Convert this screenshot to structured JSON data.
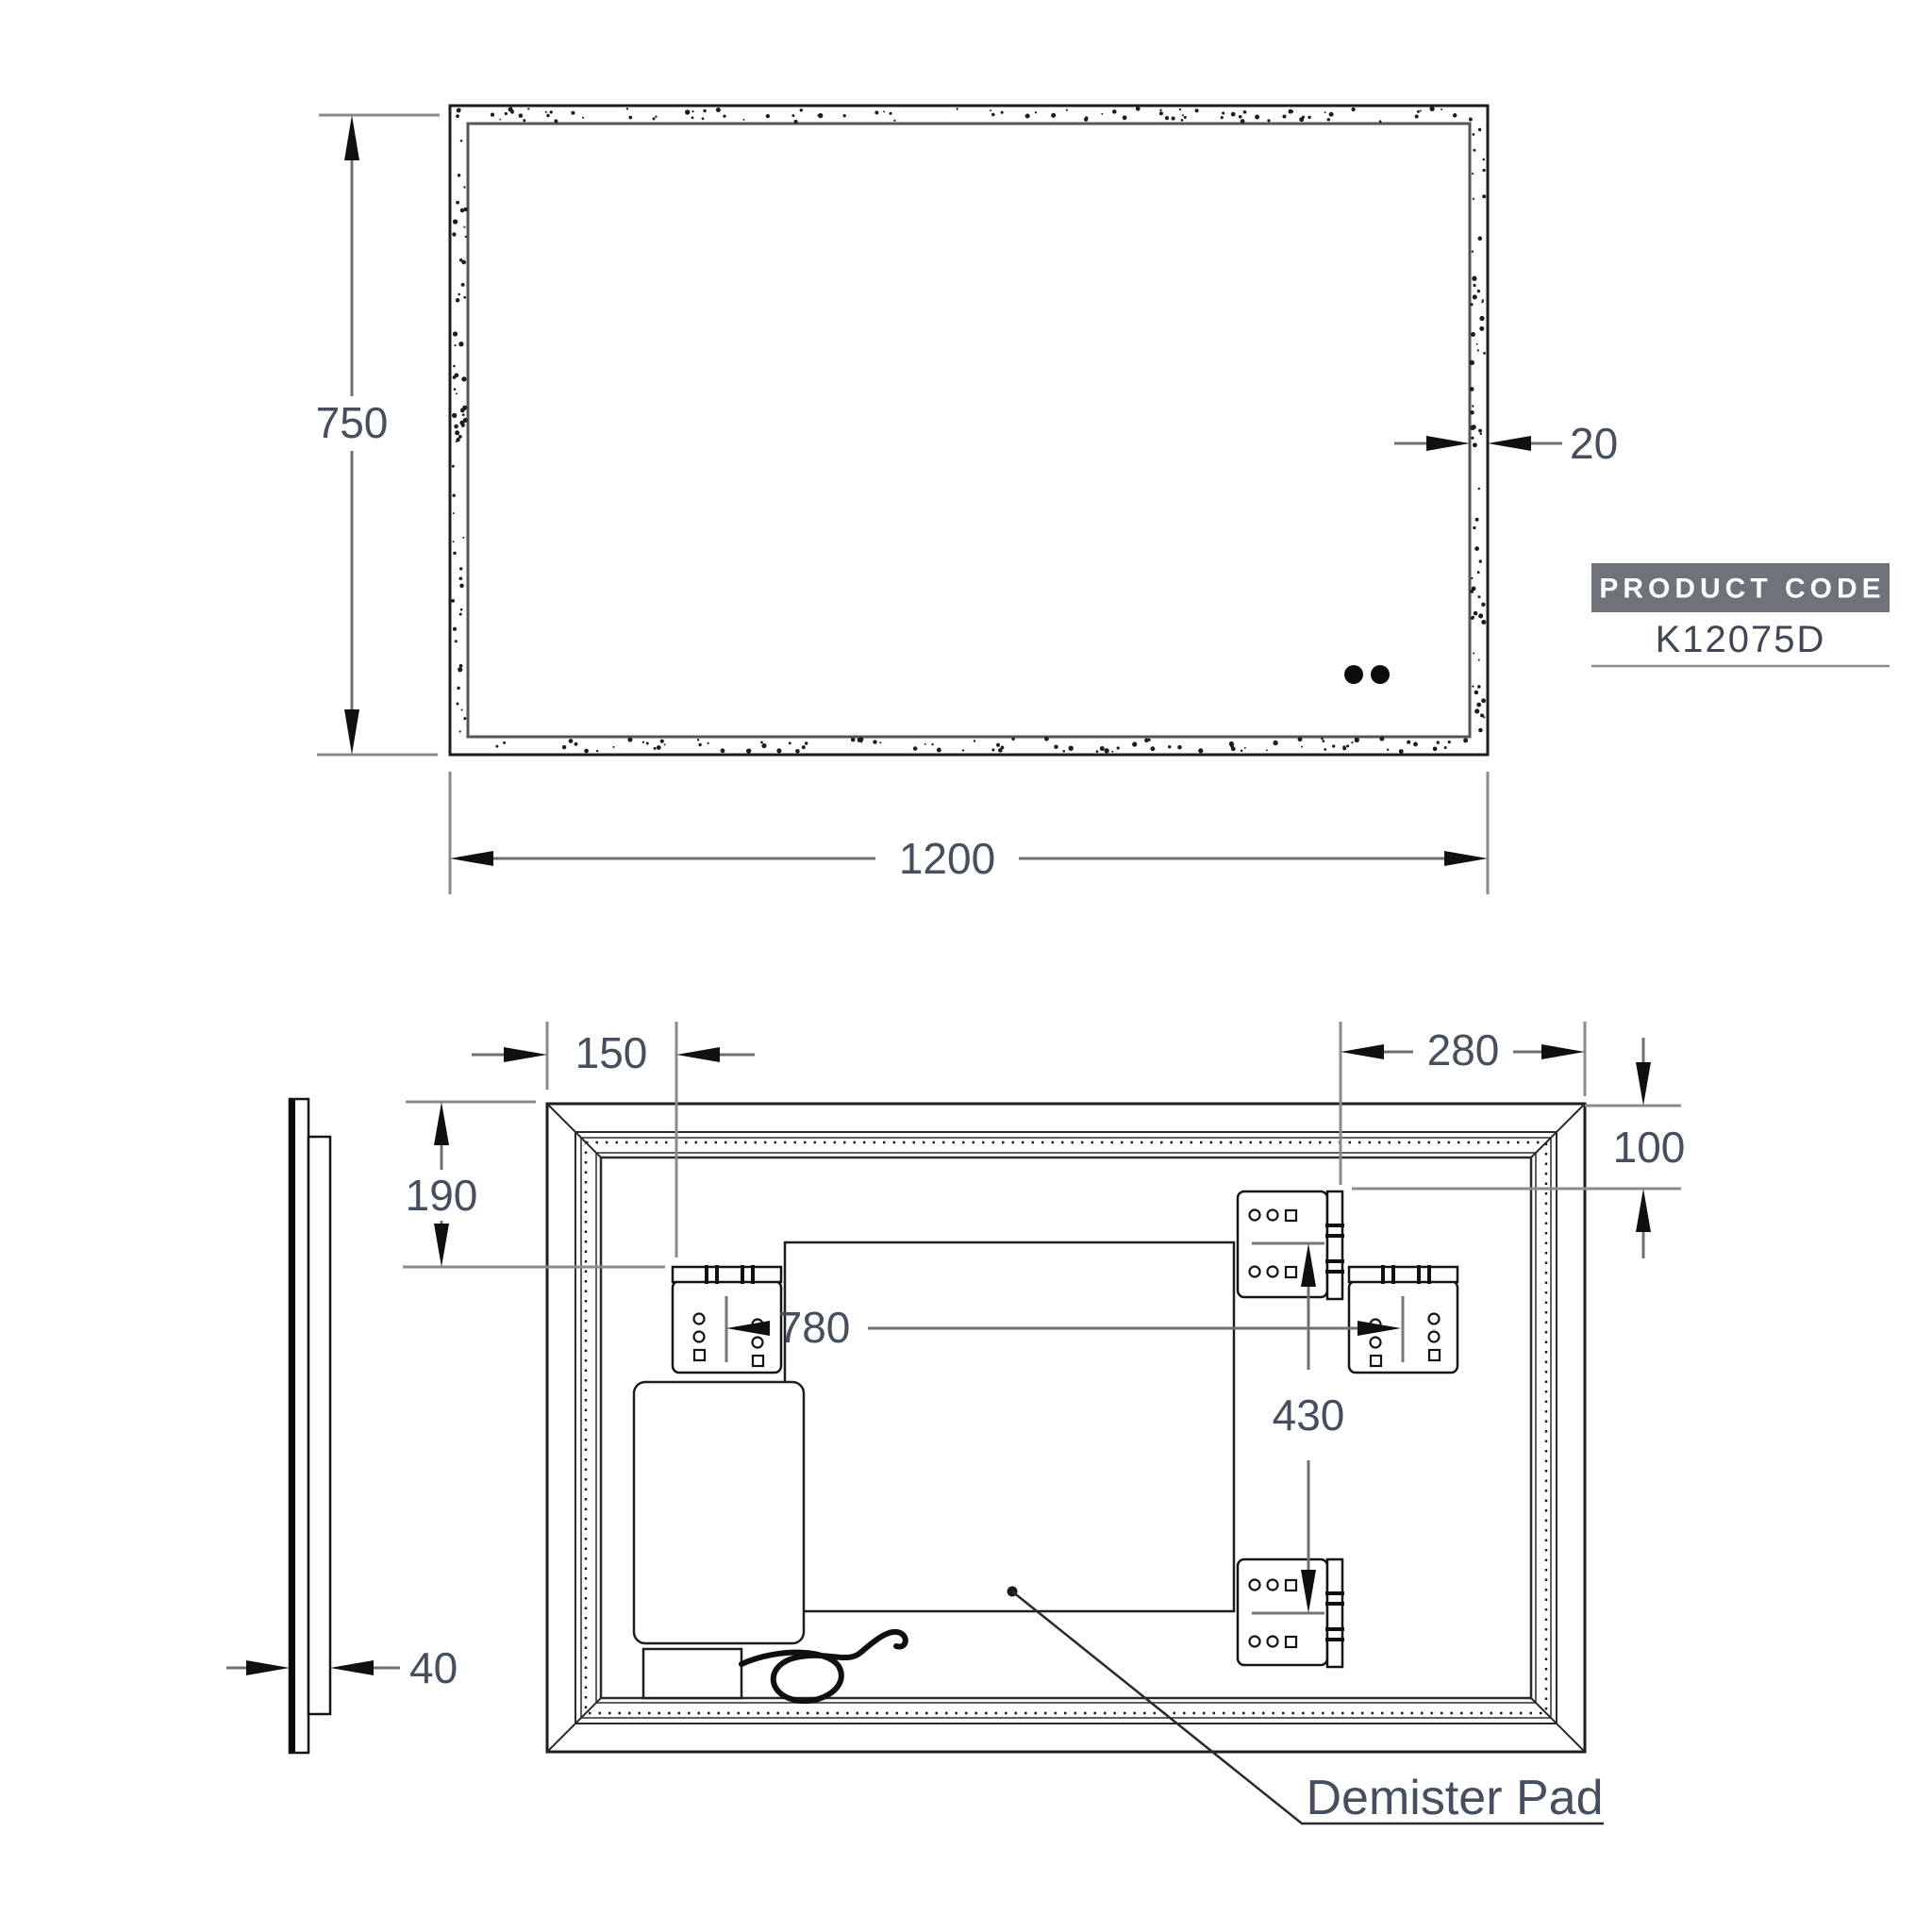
{
  "drawing": {
    "front_view": {
      "height_mm": "750",
      "width_mm": "1200",
      "frame_width_mm": "20"
    },
    "product_code": {
      "badge_label": "PRODUCT CODE",
      "code": "K12075D"
    },
    "rear_view": {
      "bracket_left_offset_mm": "150",
      "bracket_top_clearance_mm": "190",
      "bracket_right_offset_mm": "280",
      "bracket_top_offset_mm": "100",
      "bracket_horizontal_span_mm": "780",
      "bracket_vertical_span_mm": "430",
      "mirror_depth_mm": "40",
      "demister_pad_label": "Demister Pad"
    },
    "colors": {
      "line": "#1e1e1e",
      "dimension_text": "#454f5d",
      "badge_background": "#6d7378",
      "badge_text": "#ffffff"
    }
  }
}
